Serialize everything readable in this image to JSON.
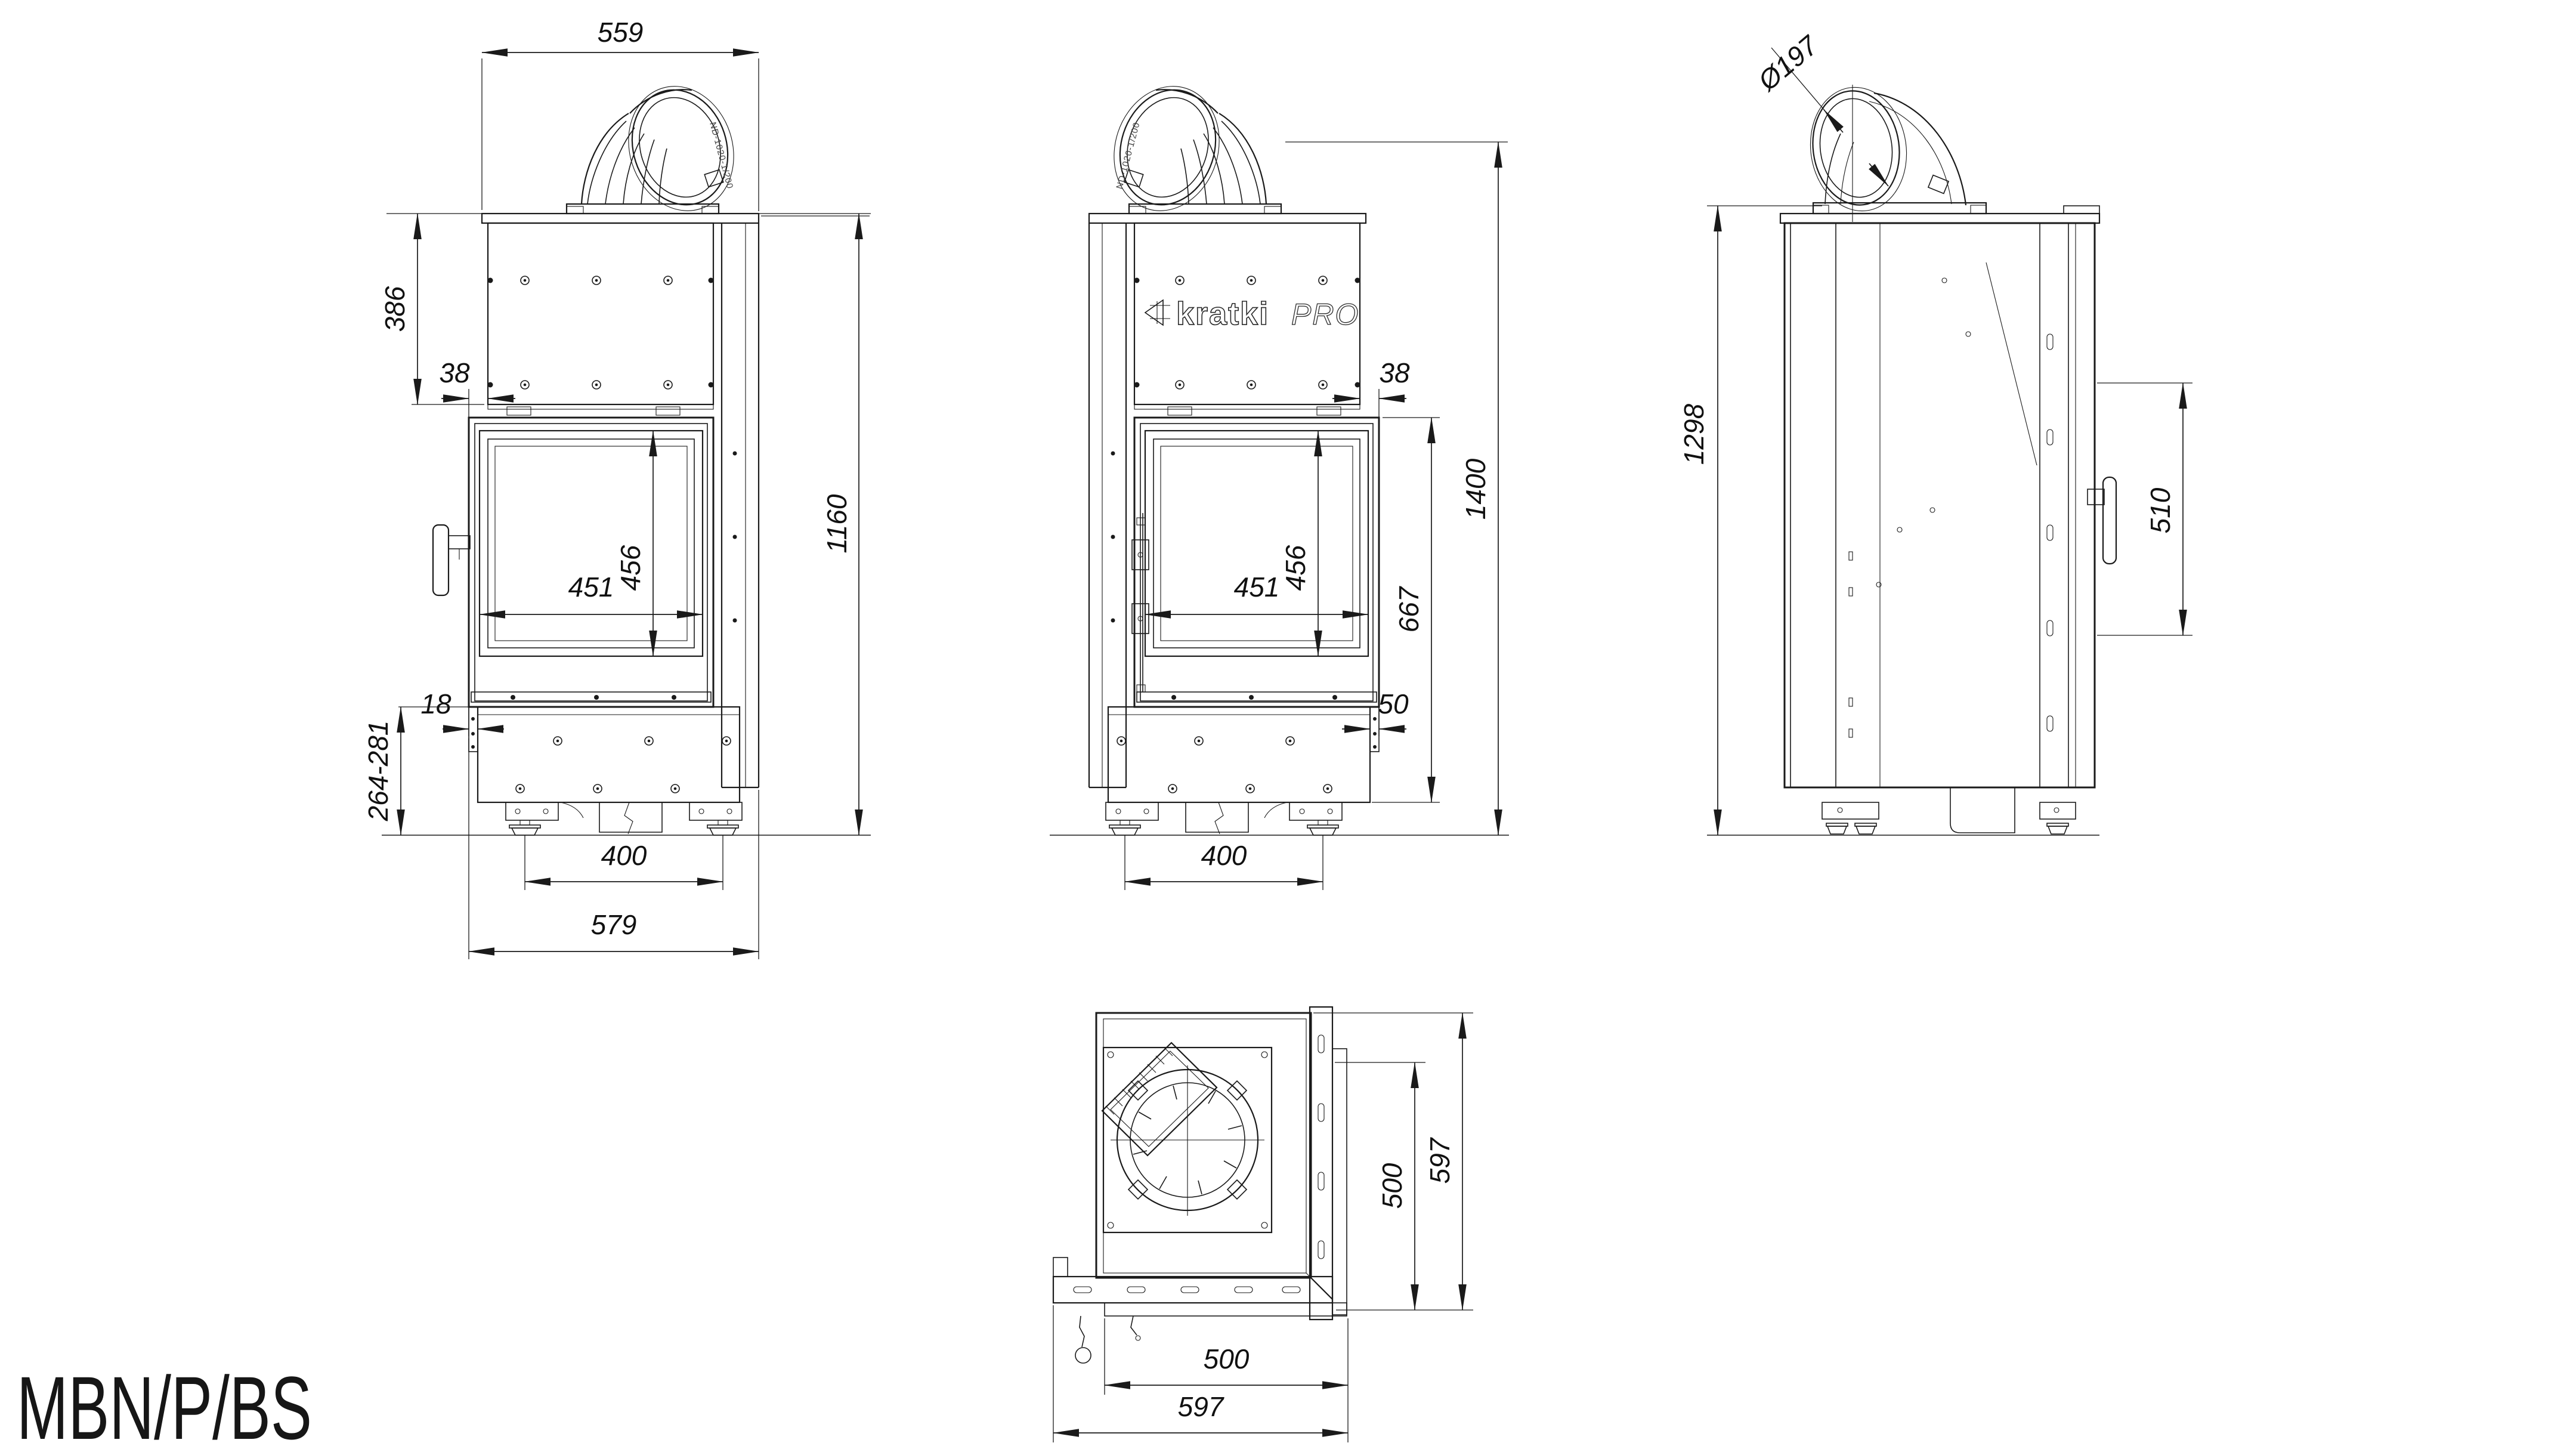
{
  "page": {
    "model_label": "MBN/P/BS"
  },
  "brand": {
    "logo_main": "kratki",
    "logo_suffix": "PRO",
    "flue_cast_marking": "ND-1020-1/200"
  },
  "front_view": {
    "dim_top_width": "559",
    "dim_upper_height": "386",
    "dim_door_offset": "38",
    "dim_glass_width": "451",
    "dim_glass_height": "456",
    "dim_total_height": "1160",
    "dim_plinth_offset": "18",
    "dim_plinth_height": "264-281",
    "dim_feet_spacing": "400",
    "dim_overall_width": "579"
  },
  "rear_view": {
    "dim_door_offset": "38",
    "dim_glass_width": "451",
    "dim_glass_height": "456",
    "dim_door_section_height": "667",
    "dim_total_height": "1400",
    "dim_base_offset": "50",
    "dim_feet_spacing": "400"
  },
  "side_view": {
    "dim_flue_diameter": "Ø197",
    "dim_body_height": "1298",
    "dim_side_glass_height": "510"
  },
  "top_view": {
    "dim_glass_depth": "500",
    "dim_overall_depth": "597",
    "dim_glass_width": "500",
    "dim_overall_width": "597"
  }
}
